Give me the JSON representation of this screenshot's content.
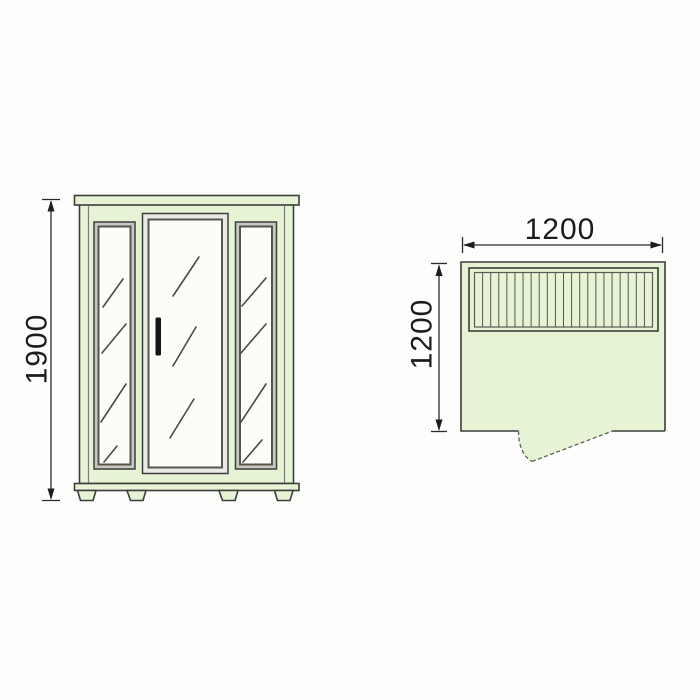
{
  "diagram": {
    "front_view": {
      "height_dim_label": "1900"
    },
    "top_view": {
      "width_dim_label": "1200",
      "depth_dim_label": "1200",
      "bench_slat_count": 21
    },
    "colors": {
      "background": "#fdfdfb",
      "panel_green": "#e6f3d5",
      "glass_white": "#fcfcf9",
      "frame_gray": "#c9c9c2",
      "outline_dark": "#3d3d3d",
      "dimension_text": "#1c1c1c",
      "handle_black": "#141414"
    }
  }
}
